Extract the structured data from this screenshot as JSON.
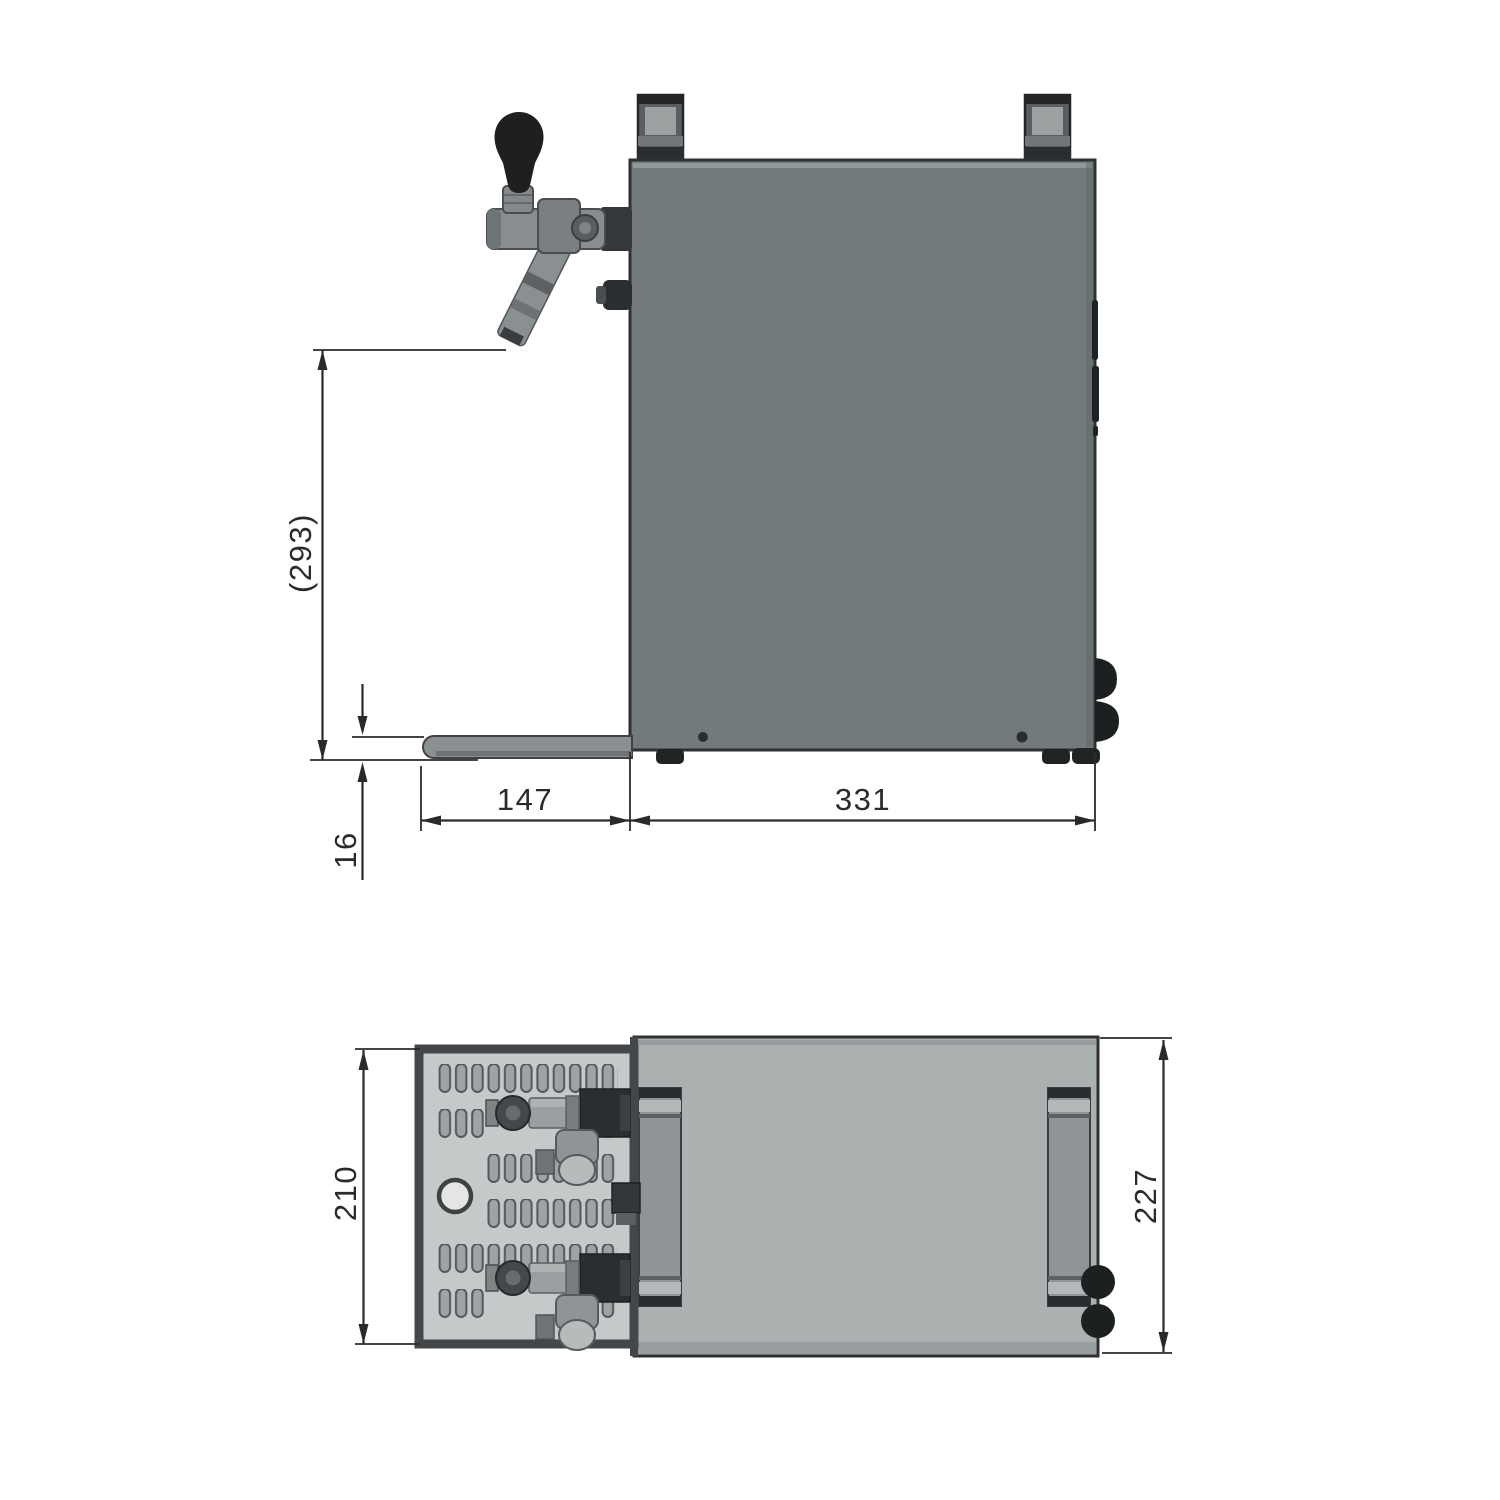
{
  "drawing": {
    "type": "technical-dimension-drawing",
    "subject": "beer dispenser / tap cooler, side view and top view",
    "dims": {
      "spout_height": "(293)",
      "drip_tray_thickness": "16",
      "drip_tray_length": "147",
      "housing_length": "331",
      "drip_tray_width": "210",
      "housing_width": "227"
    },
    "colors": {
      "side_body": "#737a7b",
      "side_body_highlight": "#979d9e",
      "top_body": "#abb0b1",
      "top_body_band": "#989e9f",
      "tray_plate": "#c6c9ca",
      "side_tray": "#8b9092",
      "outline": "#2e3132",
      "dark_part": "#1d2021",
      "dim_color": "#2a2a2a",
      "background": "#ffffff"
    }
  }
}
